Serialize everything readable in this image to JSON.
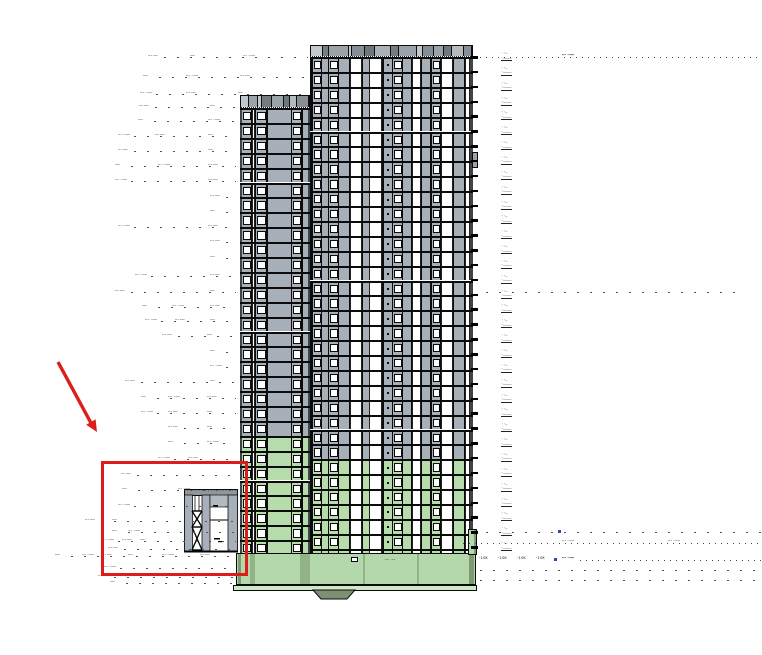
{
  "document": {
    "description": "Architectural elevation drawing of a two-part residential high-rise tower; lower storeys and podium shaded green; a red markup rectangle and red arrow highlight the low canopy / braced link structure left of the tower base"
  },
  "annotations": {
    "label_short": "——",
    "label_mid": "—·——",
    "label_long": "—··——",
    "level_top": "··—",
    "level_bottom": "·————",
    "tag_bold": "—··——",
    "tsk": "·ısĸ",
    "podium_note": "·— —·"
  },
  "colors": {
    "panel_gray": "#a7b0b8",
    "green_tint": "#b6dcac",
    "podium_green": "#b4d8ab",
    "slab_green": "#cfe8c6",
    "ramp_olive": "#7e8f73",
    "markup_red": "#dd1c1c",
    "blue_tick": "#2b49c0"
  }
}
